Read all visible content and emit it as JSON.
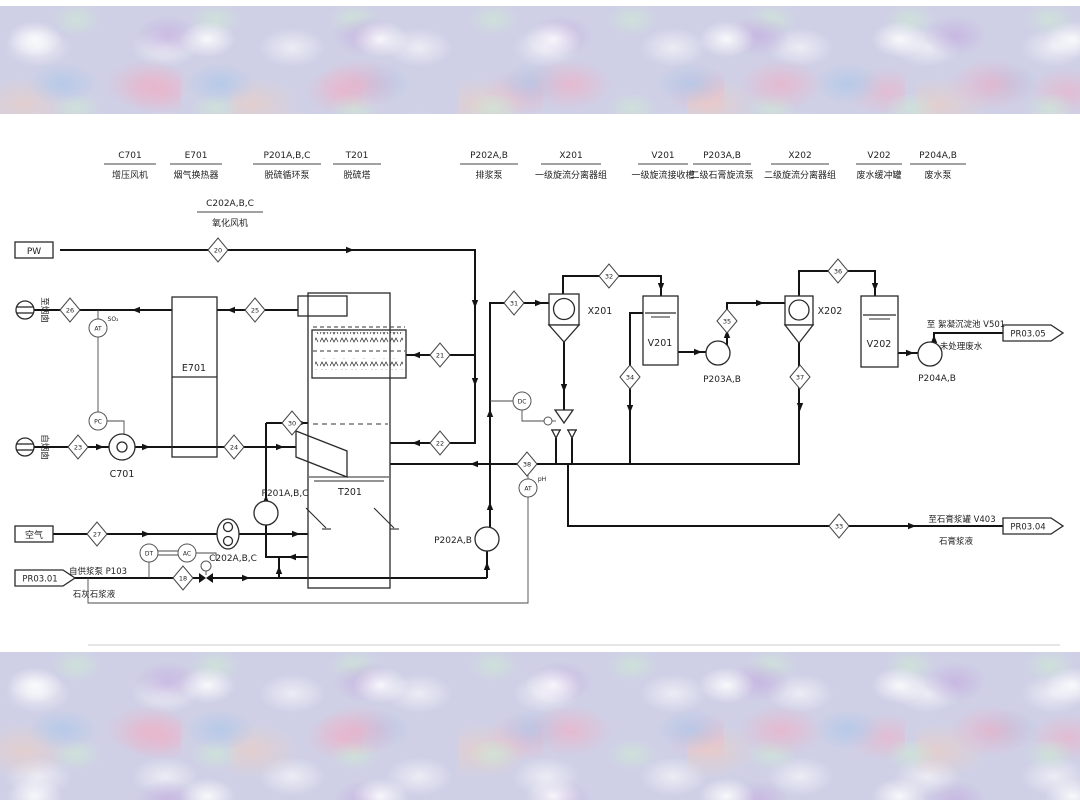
{
  "legend": {
    "items": [
      {
        "code": "C701",
        "name": "增压风机"
      },
      {
        "code": "E701",
        "name": "烟气换热器"
      },
      {
        "code": "P201A,B,C",
        "name": "脱硫循环泵"
      },
      {
        "code": "T201",
        "name": "脱硫塔"
      },
      {
        "code": "C202A,B,C",
        "name": "氧化风机"
      },
      {
        "code": "P202A,B",
        "name": "排浆泵"
      },
      {
        "code": "X201",
        "name": "一级旋流分离器组"
      },
      {
        "code": "V201",
        "name": "一级旋流接收槽"
      },
      {
        "code": "P203A,B",
        "name": "二级石膏旋流泵"
      },
      {
        "code": "X202",
        "name": "二级旋流分离器组"
      },
      {
        "code": "V202",
        "name": "废水缓冲罐"
      },
      {
        "code": "P204A,B",
        "name": "废水泵"
      }
    ]
  },
  "equipment_tags": {
    "c701": "C701",
    "e701": "E701",
    "t201": "T201",
    "p201": "P201A,B,C",
    "c202": "C202A,B,C",
    "p202": "P202A,B",
    "x201": "X201",
    "v201": "V201",
    "p203": "P203A,B",
    "x202": "X202",
    "v202": "V202",
    "p204": "P204A,B"
  },
  "flow_tags": {
    "t18": "18",
    "t20": "20",
    "t21": "21",
    "t22": "22",
    "t23": "23",
    "t24": "24",
    "t25": "25",
    "t26": "26",
    "t27": "27",
    "t30": "30",
    "t31": "31",
    "t32": "32",
    "t33": "33",
    "t34": "34",
    "t35": "35",
    "t36": "36",
    "t37": "37",
    "t38": "38"
  },
  "instruments": {
    "at_so2": {
      "tag": "AT",
      "note": "SO₂"
    },
    "pc": {
      "tag": "PC"
    },
    "dt": {
      "tag": "DT"
    },
    "ac": {
      "tag": "AC"
    },
    "dc": {
      "tag": "DC"
    },
    "at_ph": {
      "tag": "AT",
      "note": "pH"
    }
  },
  "streams": {
    "pw": "PW",
    "air": "空气",
    "to_stack": "至烟囱",
    "from_stack": "自烟囱",
    "pr03_01": "PR03.01",
    "pr03_04": "PR03.04",
    "pr03_05": "PR03.05",
    "limestone_src": "自供浆泵 P103",
    "limestone": "石灰石浆液",
    "gypsum_dest": "至石膏浆罐  V403",
    "gypsum": "石膏浆液",
    "ww_dest": "至 絮凝沉淀池 V501",
    "ww": "未处理废水"
  }
}
